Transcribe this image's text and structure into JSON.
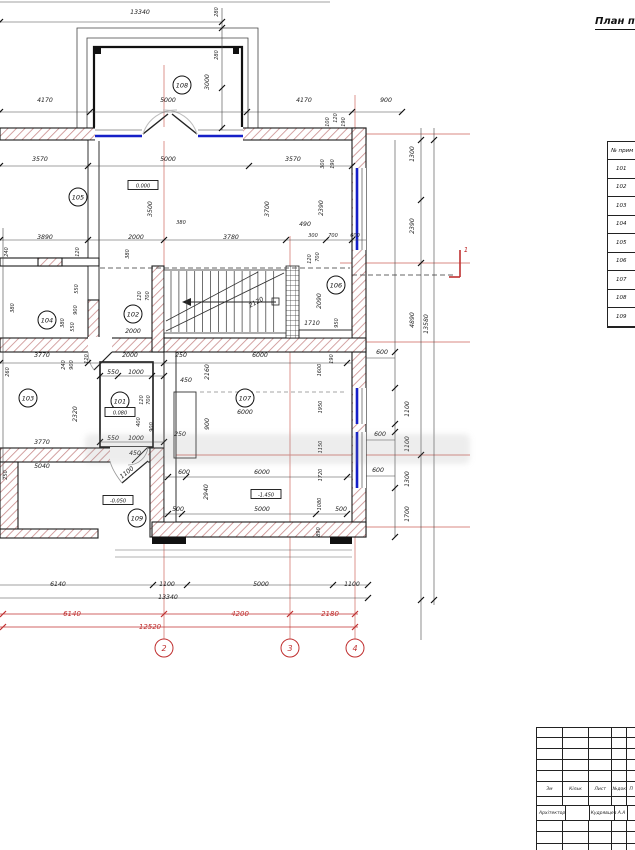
{
  "title": "План п",
  "section_mark": {
    "label": "1"
  },
  "room_table": {
    "header": "№ прим",
    "rows": [
      "101",
      "102",
      "103",
      "104",
      "105",
      "106",
      "107",
      "108",
      "109"
    ]
  },
  "title_block": {
    "header_cells": [
      "Зм",
      "Кільк",
      "Лист",
      "№док",
      "П"
    ],
    "architect_label": "Архітектор",
    "architect_value": "Кудрявцев А.А"
  },
  "rooms": [
    {
      "n": "108",
      "x": 182,
      "y": 85
    },
    {
      "n": "105",
      "x": 78,
      "y": 197
    },
    {
      "n": "104",
      "x": 47,
      "y": 320
    },
    {
      "n": "102",
      "x": 133,
      "y": 314
    },
    {
      "n": "106",
      "x": 336,
      "y": 285
    },
    {
      "n": "103",
      "x": 28,
      "y": 398
    },
    {
      "n": "101",
      "x": 120,
      "y": 401
    },
    {
      "n": "107",
      "x": 245,
      "y": 398
    },
    {
      "n": "109",
      "x": 137,
      "y": 518
    }
  ],
  "levels": [
    {
      "t": "0.000",
      "x": 143,
      "y": 187
    },
    {
      "t": "0.080",
      "x": 120,
      "y": 414
    },
    {
      "t": "-1.450",
      "x": 266,
      "y": 496
    },
    {
      "t": "-0.050",
      "x": 118,
      "y": 502
    }
  ],
  "grid_bubbles": [
    {
      "n": "2",
      "x": 164,
      "y": 648
    },
    {
      "n": "3",
      "x": 290,
      "y": 648
    },
    {
      "n": "4",
      "x": 355,
      "y": 648
    }
  ],
  "dims": [
    {
      "t": "13340",
      "x": 140,
      "y": 14
    },
    {
      "t": "280",
      "x": 218,
      "y": 12,
      "r": -90,
      "s": 5
    },
    {
      "t": "280",
      "x": 218,
      "y": 55,
      "r": -90,
      "s": 5
    },
    {
      "t": "3000",
      "x": 209,
      "y": 82,
      "r": -90
    },
    {
      "t": "4170",
      "x": 45,
      "y": 102
    },
    {
      "t": "5000",
      "x": 168,
      "y": 102
    },
    {
      "t": "4170",
      "x": 304,
      "y": 102
    },
    {
      "t": "900",
      "x": 386,
      "y": 102
    },
    {
      "t": "100",
      "x": 329,
      "y": 122,
      "r": -90,
      "s": 5
    },
    {
      "t": "120",
      "x": 337,
      "y": 118,
      "r": -90,
      "s": 5
    },
    {
      "t": "190",
      "x": 345,
      "y": 122,
      "r": -90,
      "s": 5
    },
    {
      "t": "3570",
      "x": 40,
      "y": 161
    },
    {
      "t": "5000",
      "x": 168,
      "y": 161
    },
    {
      "t": "3570",
      "x": 293,
      "y": 161
    },
    {
      "t": "300",
      "x": 324,
      "y": 164,
      "r": -90,
      "s": 5
    },
    {
      "t": "190",
      "x": 334,
      "y": 164,
      "r": -90,
      "s": 5
    },
    {
      "t": "1300",
      "x": 414,
      "y": 154,
      "r": -90
    },
    {
      "t": "3500",
      "x": 152,
      "y": 209,
      "r": -90
    },
    {
      "t": "3700",
      "x": 269,
      "y": 209,
      "r": -90
    },
    {
      "t": "2390",
      "x": 323,
      "y": 208,
      "r": -90
    },
    {
      "t": "2390",
      "x": 414,
      "y": 226,
      "r": -90
    },
    {
      "t": "3890",
      "x": 45,
      "y": 239
    },
    {
      "t": "2000",
      "x": 136,
      "y": 239
    },
    {
      "t": "380",
      "x": 181,
      "y": 224,
      "s": 5
    },
    {
      "t": "3780",
      "x": 231,
      "y": 239
    },
    {
      "t": "490",
      "x": 305,
      "y": 226
    },
    {
      "t": "300",
      "x": 313,
      "y": 237,
      "s": 5
    },
    {
      "t": "700",
      "x": 333,
      "y": 237,
      "s": 5
    },
    {
      "t": "600",
      "x": 355,
      "y": 237,
      "s": 5
    },
    {
      "t": "120",
      "x": 79,
      "y": 252,
      "r": -90,
      "s": 5
    },
    {
      "t": "380",
      "x": 129,
      "y": 254,
      "r": -90,
      "s": 5
    },
    {
      "t": "240",
      "x": 8,
      "y": 252,
      "r": -90,
      "s": 5
    },
    {
      "t": "550",
      "x": 78,
      "y": 289,
      "r": -90,
      "s": 5
    },
    {
      "t": "900",
      "x": 77,
      "y": 310,
      "r": -90,
      "s": 5
    },
    {
      "t": "550",
      "x": 74,
      "y": 327,
      "r": -90,
      "s": 5
    },
    {
      "t": "380",
      "x": 64,
      "y": 323,
      "r": -90,
      "s": 5
    },
    {
      "t": "380",
      "x": 14,
      "y": 308,
      "r": -90,
      "s": 5
    },
    {
      "t": "2000",
      "x": 133,
      "y": 333
    },
    {
      "t": "120",
      "x": 141,
      "y": 296,
      "r": -90,
      "s": 5
    },
    {
      "t": "700",
      "x": 149,
      "y": 296,
      "r": -90,
      "s": 5
    },
    {
      "t": "120",
      "x": 311,
      "y": 259,
      "r": -90,
      "s": 5
    },
    {
      "t": "700",
      "x": 319,
      "y": 257,
      "r": -90,
      "s": 5
    },
    {
      "t": "2090",
      "x": 321,
      "y": 301,
      "r": -90
    },
    {
      "t": "1710",
      "x": 312,
      "y": 325
    },
    {
      "t": "950",
      "x": 338,
      "y": 323,
      "r": -90,
      "s": 5
    },
    {
      "t": "2120",
      "x": 257,
      "y": 304,
      "r": -28
    },
    {
      "t": "3770",
      "x": 42,
      "y": 357
    },
    {
      "t": "2000",
      "x": 130,
      "y": 357
    },
    {
      "t": "250",
      "x": 181,
      "y": 357
    },
    {
      "t": "6000",
      "x": 260,
      "y": 357
    },
    {
      "t": "190",
      "x": 333,
      "y": 359,
      "r": -90,
      "s": 5
    },
    {
      "t": "120",
      "x": 88,
      "y": 359,
      "r": -90,
      "s": 5
    },
    {
      "t": "260",
      "x": 9,
      "y": 372,
      "r": -90,
      "s": 5
    },
    {
      "t": "240",
      "x": 65,
      "y": 365,
      "r": -90,
      "s": 5
    },
    {
      "t": "900",
      "x": 73,
      "y": 365,
      "r": -90,
      "s": 5
    },
    {
      "t": "2320",
      "x": 77,
      "y": 414,
      "r": -90
    },
    {
      "t": "3770",
      "x": 42,
      "y": 444
    },
    {
      "t": "550",
      "x": 113,
      "y": 374
    },
    {
      "t": "1000",
      "x": 136,
      "y": 374
    },
    {
      "t": "450",
      "x": 186,
      "y": 382
    },
    {
      "t": "120",
      "x": 143,
      "y": 400,
      "r": -90,
      "s": 5
    },
    {
      "t": "700",
      "x": 150,
      "y": 400,
      "r": -90,
      "s": 5
    },
    {
      "t": "400",
      "x": 140,
      "y": 422,
      "r": -90,
      "s": 5
    },
    {
      "t": "900",
      "x": 153,
      "y": 427,
      "r": -90,
      "s": 5
    },
    {
      "t": "550",
      "x": 113,
      "y": 440
    },
    {
      "t": "1000",
      "x": 136,
      "y": 440
    },
    {
      "t": "250",
      "x": 180,
      "y": 436
    },
    {
      "t": "450",
      "x": 135,
      "y": 455
    },
    {
      "t": "1100",
      "x": 128,
      "y": 474,
      "r": -38
    },
    {
      "t": "2160",
      "x": 209,
      "y": 372,
      "r": -90
    },
    {
      "t": "900",
      "x": 209,
      "y": 424,
      "r": -90
    },
    {
      "t": "6000",
      "x": 245,
      "y": 414
    },
    {
      "t": "600",
      "x": 184,
      "y": 474
    },
    {
      "t": "6000",
      "x": 262,
      "y": 474
    },
    {
      "t": "2940",
      "x": 208,
      "y": 492,
      "r": -90
    },
    {
      "t": "500",
      "x": 178,
      "y": 511
    },
    {
      "t": "5000",
      "x": 262,
      "y": 511
    },
    {
      "t": "500",
      "x": 341,
      "y": 511
    },
    {
      "t": "1600",
      "x": 321,
      "y": 370,
      "r": -90,
      "s": 5
    },
    {
      "t": "1950",
      "x": 322,
      "y": 407,
      "r": -90,
      "s": 5
    },
    {
      "t": "1150",
      "x": 322,
      "y": 447,
      "r": -90,
      "s": 5
    },
    {
      "t": "1720",
      "x": 322,
      "y": 475,
      "r": -90,
      "s": 5
    },
    {
      "t": "1080",
      "x": 321,
      "y": 504,
      "r": -90,
      "s": 5
    },
    {
      "t": "890",
      "x": 320,
      "y": 532,
      "r": -90,
      "s": 5
    },
    {
      "t": "600",
      "x": 382,
      "y": 354
    },
    {
      "t": "1100",
      "x": 409,
      "y": 409,
      "r": -90
    },
    {
      "t": "600",
      "x": 380,
      "y": 436
    },
    {
      "t": "1100",
      "x": 409,
      "y": 444,
      "r": -90
    },
    {
      "t": "600",
      "x": 378,
      "y": 472
    },
    {
      "t": "1300",
      "x": 409,
      "y": 479,
      "r": -90
    },
    {
      "t": "1700",
      "x": 409,
      "y": 514,
      "r": -90
    },
    {
      "t": "4890",
      "x": 414,
      "y": 320,
      "r": -90
    },
    {
      "t": "13580",
      "x": 428,
      "y": 324,
      "r": -90
    },
    {
      "t": "5040",
      "x": 42,
      "y": 468
    },
    {
      "t": "250",
      "x": 7,
      "y": 475,
      "r": -90,
      "s": 5
    },
    {
      "t": "6140",
      "x": 58,
      "y": 586
    },
    {
      "t": "1100",
      "x": 167,
      "y": 586
    },
    {
      "t": "5000",
      "x": 261,
      "y": 586
    },
    {
      "t": "1100",
      "x": 352,
      "y": 586
    },
    {
      "t": "13340",
      "x": 168,
      "y": 599
    }
  ],
  "dims_red": [
    {
      "t": "6140",
      "x": 72,
      "y": 616
    },
    {
      "t": "4200",
      "x": 240,
      "y": 616
    },
    {
      "t": "2180",
      "x": 330,
      "y": 616
    },
    {
      "t": "12520",
      "x": 150,
      "y": 629
    }
  ]
}
